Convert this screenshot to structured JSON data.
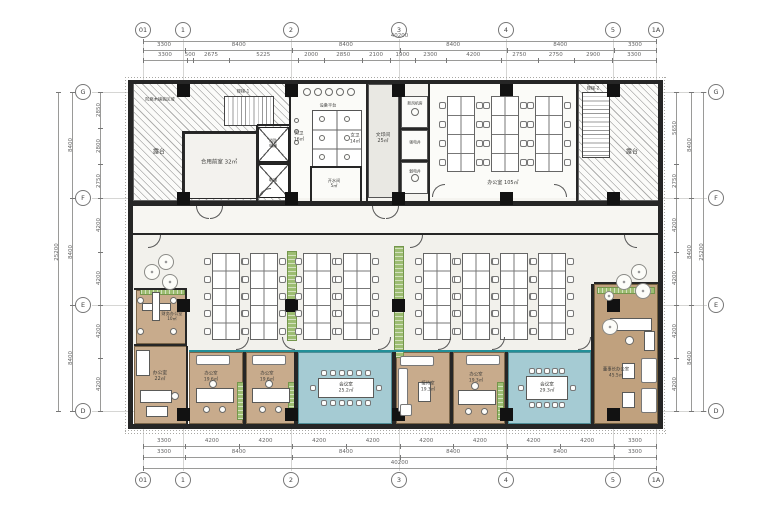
{
  "meta": {
    "width": 780,
    "height": 520,
    "bg": "#ffffff",
    "accent_teal": "#238f98",
    "accent_green": "#9dbd72",
    "accent_wood": "#c8ab8c"
  },
  "grid": {
    "cols": [
      {
        "label": "01",
        "x": 143
      },
      {
        "label": "1",
        "x": 183
      },
      {
        "label": "2",
        "x": 291
      },
      {
        "label": "3",
        "x": 399
      },
      {
        "label": "4",
        "x": 506
      },
      {
        "label": "5",
        "x": 613
      },
      {
        "label": "1A",
        "x": 656
      }
    ],
    "rows": [
      {
        "label": "G",
        "y": 92
      },
      {
        "label": "F",
        "y": 198
      },
      {
        "label": "E",
        "y": 305
      },
      {
        "label": "D",
        "y": 411
      }
    ],
    "top_y": 30,
    "bottom_y": 480,
    "left_x": 83,
    "right_x": 716
  },
  "dims": {
    "top": {
      "total": [
        "40200"
      ],
      "majors": [
        "3300",
        "8400",
        "8400",
        "8400",
        "8400",
        "3300"
      ],
      "minors": [
        "3300",
        "500",
        "2675",
        "5225",
        "2000",
        "2850",
        "2100",
        "1900",
        "2300",
        "4200",
        "2750",
        "2750",
        "2900",
        "3300"
      ]
    },
    "bottom": {
      "total": [
        "40200"
      ],
      "majors": [
        "3300",
        "8400",
        "8400",
        "8400",
        "8400",
        "3300"
      ],
      "minors": [
        "3300",
        "4200",
        "4200",
        "4200",
        "4200",
        "4200",
        "4200",
        "4200",
        "4200",
        "3300"
      ]
    },
    "left": {
      "total": [
        "25200"
      ],
      "majors": [
        "8400",
        "8400",
        "8400"
      ],
      "minors": [
        "2850",
        "2800",
        "2750",
        "4200",
        "4200",
        "4200",
        "4200"
      ]
    },
    "right": {
      "total": [
        "25200"
      ],
      "majors": [
        "8400",
        "8400",
        "8400"
      ],
      "minors": [
        "5650",
        "2750",
        "4200",
        "4200",
        "4200",
        "4200"
      ]
    }
  },
  "plan": {
    "floors": [
      {
        "n": "top-band-floor",
        "c": "floor-top",
        "x": 133,
        "y": 84,
        "w": 525,
        "h": 117
      },
      {
        "n": "terrace-left",
        "c": "hatch",
        "x": 133,
        "y": 82,
        "w": 157,
        "h": 119
      },
      {
        "n": "terrace-right",
        "c": "hatch",
        "x": 578,
        "y": 82,
        "w": 82,
        "h": 119
      },
      {
        "n": "stair-1",
        "c": "stairsH",
        "x": 224,
        "y": 96,
        "w": 50,
        "h": 30
      },
      {
        "n": "stair-2",
        "c": "stairsV",
        "x": 582,
        "y": 92,
        "w": 28,
        "h": 66
      },
      {
        "n": "shared-lobby",
        "c": "froom",
        "x": 184,
        "y": 133,
        "w": 73,
        "h": 66
      },
      {
        "n": "elevator-fire",
        "c": "elev",
        "x": 258,
        "y": 127,
        "w": 31,
        "h": 35
      },
      {
        "n": "elevator",
        "c": "elev",
        "x": 258,
        "y": 164,
        "w": 31,
        "h": 34
      },
      {
        "n": "toilet-zone",
        "c": "white",
        "x": 291,
        "y": 84,
        "w": 76,
        "h": 114
      },
      {
        "n": "toilet-stalls",
        "c": "stall",
        "x": 312,
        "y": 110,
        "w": 50,
        "h": 58
      },
      {
        "n": "water-room",
        "c": "white",
        "x": 312,
        "y": 168,
        "w": 48,
        "h": 30
      },
      {
        "n": "print-room",
        "c": "gray",
        "x": 368,
        "y": 84,
        "w": 31,
        "h": 114
      },
      {
        "n": "shaft-cell-1",
        "c": "cell",
        "x": 401,
        "y": 96,
        "w": 27,
        "h": 32
      },
      {
        "n": "shaft-cell-2",
        "c": "cell",
        "x": 401,
        "y": 130,
        "w": 27,
        "h": 30
      },
      {
        "n": "shaft-cell-3",
        "c": "cell",
        "x": 401,
        "y": 162,
        "w": 27,
        "h": 32
      },
      {
        "n": "office-top-floor",
        "c": "white",
        "x": 430,
        "y": 84,
        "w": 146,
        "h": 114
      },
      {
        "n": "corridor-floor",
        "c": "floor-cor",
        "x": 133,
        "y": 206,
        "w": 525,
        "h": 27
      },
      {
        "n": "open-office-floor",
        "c": "floor-open",
        "x": 133,
        "y": 235,
        "w": 525,
        "h": 115
      },
      {
        "n": "finance-office",
        "c": "wood",
        "x": 136,
        "y": 290,
        "w": 51,
        "h": 54
      },
      {
        "n": "office-22",
        "c": "wood",
        "x": 134,
        "y": 346,
        "w": 53,
        "h": 78
      },
      {
        "n": "office-a",
        "c": "wood",
        "x": 189,
        "y": 352,
        "w": 54,
        "h": 72
      },
      {
        "n": "office-b",
        "c": "wood",
        "x": 246,
        "y": 352,
        "w": 50,
        "h": 72
      },
      {
        "n": "meeting-1",
        "c": "teal",
        "x": 298,
        "y": 352,
        "w": 94,
        "h": 72
      },
      {
        "n": "reception",
        "c": "wood",
        "x": 396,
        "y": 352,
        "w": 54,
        "h": 72
      },
      {
        "n": "office-193",
        "c": "wood",
        "x": 453,
        "y": 352,
        "w": 52,
        "h": 72
      },
      {
        "n": "meeting-2",
        "c": "teal",
        "x": 508,
        "y": 352,
        "w": 83,
        "h": 72
      },
      {
        "n": "chairman-office",
        "c": "wood2",
        "x": 594,
        "y": 284,
        "w": 64,
        "h": 140
      }
    ],
    "walls": [
      [
        128,
        80,
        535,
        4
      ],
      [
        128,
        201,
        535,
        5
      ],
      [
        128,
        233,
        535,
        2
      ],
      [
        128,
        424,
        535,
        5
      ],
      [
        128,
        80,
        5,
        349
      ],
      [
        658,
        80,
        5,
        349
      ],
      [
        182,
        131,
        2,
        70
      ],
      [
        183,
        131,
        75,
        2
      ],
      [
        256,
        125,
        2,
        76
      ],
      [
        257,
        124,
        33,
        2
      ],
      [
        257,
        162,
        33,
        2
      ],
      [
        289,
        84,
        2,
        117
      ],
      [
        366,
        84,
        2,
        117
      ],
      [
        399,
        84,
        2,
        117
      ],
      [
        428,
        84,
        2,
        117
      ],
      [
        576,
        82,
        2,
        119
      ],
      [
        401,
        128,
        28,
        2
      ],
      [
        401,
        160,
        28,
        2
      ],
      [
        310,
        166,
        52,
        2
      ],
      [
        310,
        168,
        2,
        33
      ],
      [
        360,
        168,
        2,
        33
      ],
      [
        134,
        288,
        53,
        2
      ],
      [
        185,
        288,
        2,
        58
      ],
      [
        134,
        344,
        53,
        2
      ],
      [
        186,
        346,
        2,
        78
      ],
      [
        243,
        352,
        3,
        72
      ],
      [
        294,
        352,
        4,
        72
      ],
      [
        392,
        352,
        4,
        72
      ],
      [
        450,
        352,
        3,
        72
      ],
      [
        505,
        352,
        3,
        72
      ],
      [
        591,
        284,
        3,
        140
      ],
      [
        594,
        282,
        66,
        2
      ]
    ],
    "glass": [
      [
        189,
        350,
        402,
        2
      ]
    ],
    "columns": {
      "size": 13,
      "xs": [
        177,
        285,
        392,
        500,
        607
      ],
      "ys": [
        84,
        192,
        299,
        408
      ]
    },
    "planters": [
      {
        "c": "planter",
        "x": 287,
        "y": 251,
        "w": 10,
        "h": 90
      },
      {
        "c": "planter",
        "x": 394,
        "y": 246,
        "w": 10,
        "h": 112
      },
      {
        "c": "planterH",
        "x": 140,
        "y": 288,
        "w": 45,
        "h": 7
      },
      {
        "c": "planter",
        "x": 237,
        "y": 382,
        "w": 7,
        "h": 38
      },
      {
        "c": "planter",
        "x": 288,
        "y": 382,
        "w": 7,
        "h": 38
      },
      {
        "c": "planter",
        "x": 497,
        "y": 382,
        "w": 7,
        "h": 38
      },
      {
        "c": "planterH",
        "x": 597,
        "y": 287,
        "w": 58,
        "h": 7
      }
    ],
    "clusters": [
      {
        "x": 447,
        "y": 96,
        "w": 28,
        "h": 76,
        "rows": 4
      },
      {
        "x": 491,
        "y": 96,
        "w": 28,
        "h": 76,
        "rows": 4
      },
      {
        "x": 535,
        "y": 96,
        "w": 28,
        "h": 76,
        "rows": 4
      },
      {
        "x": 212,
        "y": 253,
        "w": 28,
        "h": 87,
        "rows": 5
      },
      {
        "x": 250,
        "y": 253,
        "w": 28,
        "h": 87,
        "rows": 5
      },
      {
        "x": 303,
        "y": 253,
        "w": 28,
        "h": 87,
        "rows": 5
      },
      {
        "x": 343,
        "y": 253,
        "w": 28,
        "h": 87,
        "rows": 5
      },
      {
        "x": 423,
        "y": 253,
        "w": 28,
        "h": 87,
        "rows": 5
      },
      {
        "x": 462,
        "y": 253,
        "w": 28,
        "h": 87,
        "rows": 5
      },
      {
        "x": 500,
        "y": 253,
        "w": 28,
        "h": 87,
        "rows": 5
      },
      {
        "x": 538,
        "y": 253,
        "w": 28,
        "h": 87,
        "rows": 5
      }
    ],
    "furniture": [
      {
        "c": "sofa",
        "x": 196,
        "y": 355,
        "w": 34,
        "h": 10
      },
      {
        "c": "sofa",
        "x": 252,
        "y": 355,
        "w": 34,
        "h": 10
      },
      {
        "c": "sofa",
        "x": 466,
        "y": 355,
        "w": 34,
        "h": 10
      },
      {
        "c": "desk",
        "x": 196,
        "y": 388,
        "w": 38,
        "h": 15
      },
      {
        "c": "desk",
        "x": 252,
        "y": 388,
        "w": 38,
        "h": 15
      },
      {
        "c": "desk",
        "x": 458,
        "y": 390,
        "w": 38,
        "h": 15
      },
      {
        "c": "desk",
        "x": 140,
        "y": 390,
        "w": 32,
        "h": 13
      },
      {
        "c": "desk",
        "x": 136,
        "y": 350,
        "w": 14,
        "h": 26
      },
      {
        "c": "desk",
        "x": 146,
        "y": 406,
        "w": 22,
        "h": 11
      },
      {
        "c": "desk",
        "x": 142,
        "y": 303,
        "w": 29,
        "h": 8
      },
      {
        "c": "desk",
        "x": 152,
        "y": 292,
        "w": 8,
        "h": 29
      },
      {
        "c": "sofa",
        "x": 400,
        "y": 356,
        "w": 34,
        "h": 10
      },
      {
        "c": "sofa",
        "x": 398,
        "y": 368,
        "w": 10,
        "h": 44
      },
      {
        "c": "sofa",
        "x": 400,
        "y": 404,
        "w": 12,
        "h": 12
      },
      {
        "c": "desk",
        "x": 418,
        "y": 382,
        "w": 13,
        "h": 20
      },
      {
        "c": "desk",
        "x": 610,
        "y": 318,
        "w": 42,
        "h": 13
      },
      {
        "c": "desk",
        "x": 644,
        "y": 331,
        "w": 11,
        "h": 20
      },
      {
        "c": "sofa",
        "x": 641,
        "y": 358,
        "w": 16,
        "h": 25
      },
      {
        "c": "sofa",
        "x": 641,
        "y": 388,
        "w": 16,
        "h": 25
      },
      {
        "c": "desk",
        "x": 622,
        "y": 363,
        "w": 13,
        "h": 16
      },
      {
        "c": "desk",
        "x": 622,
        "y": 392,
        "w": 13,
        "h": 16
      }
    ],
    "meetings": [
      {
        "x": 318,
        "y": 378,
        "w": 56,
        "h": 20,
        "top": 6,
        "bottom": 6,
        "left": 1,
        "right": 1
      },
      {
        "x": 526,
        "y": 376,
        "w": 42,
        "h": 24,
        "top": 5,
        "bottom": 5,
        "left": 1,
        "right": 1
      }
    ],
    "circles": [
      [
        307,
        92,
        4,
        "circ"
      ],
      [
        318,
        92,
        4,
        "circ"
      ],
      [
        329,
        92,
        4,
        "circ"
      ],
      [
        340,
        92,
        4,
        "circ"
      ],
      [
        351,
        92,
        4,
        "circ"
      ],
      [
        322,
        119,
        3,
        "circ"
      ],
      [
        347,
        119,
        3,
        "circ"
      ],
      [
        322,
        138,
        3,
        "circ"
      ],
      [
        347,
        138,
        3,
        "circ"
      ],
      [
        322,
        157,
        3,
        "circ"
      ],
      [
        347,
        157,
        3,
        "circ"
      ],
      [
        296,
        120,
        2.5,
        "circ"
      ],
      [
        296,
        131,
        2.5,
        "circ"
      ],
      [
        296,
        142,
        2.5,
        "circ"
      ],
      [
        415,
        112,
        4,
        "circ"
      ],
      [
        415,
        178,
        4,
        "circ"
      ],
      [
        152,
        272,
        8,
        "tree"
      ],
      [
        166,
        262,
        8,
        "tree"
      ],
      [
        170,
        282,
        8,
        "tree"
      ],
      [
        624,
        282,
        8,
        "tree"
      ],
      [
        639,
        272,
        8,
        "tree"
      ],
      [
        643,
        291,
        8,
        "tree"
      ],
      [
        609,
        296,
        5,
        "tree"
      ],
      [
        213,
        384,
        4,
        "circ"
      ],
      [
        206,
        409,
        3.5,
        "circ"
      ],
      [
        222,
        409,
        3.5,
        "circ"
      ],
      [
        269,
        384,
        4,
        "circ"
      ],
      [
        262,
        409,
        3.5,
        "circ"
      ],
      [
        278,
        409,
        3.5,
        "circ"
      ],
      [
        475,
        386,
        4,
        "circ"
      ],
      [
        468,
        411,
        3.5,
        "circ"
      ],
      [
        484,
        411,
        3.5,
        "circ"
      ],
      [
        175,
        396,
        4,
        "circ"
      ],
      [
        629,
        340,
        4.5,
        "circ"
      ],
      [
        610,
        327,
        8,
        "tree"
      ],
      [
        140,
        300,
        3.5,
        "circ"
      ],
      [
        173,
        300,
        3.5,
        "circ"
      ],
      [
        140,
        331,
        3.5,
        "circ"
      ],
      [
        173,
        331,
        3.5,
        "circ"
      ]
    ],
    "doors": [
      [
        196,
        206,
        "bl"
      ],
      [
        210,
        206,
        "br"
      ],
      [
        372,
        206,
        "bl"
      ],
      [
        386,
        206,
        "br"
      ],
      [
        148,
        235,
        "br"
      ],
      [
        410,
        235,
        "br"
      ],
      [
        624,
        235,
        "bl"
      ],
      [
        432,
        184,
        "tl"
      ],
      [
        554,
        184,
        "tr"
      ],
      [
        258,
        188,
        "tl"
      ],
      [
        236,
        337,
        "br"
      ],
      [
        282,
        337,
        "bl"
      ],
      [
        378,
        337,
        "br"
      ],
      [
        438,
        337,
        "br"
      ],
      [
        492,
        337,
        "br"
      ],
      [
        578,
        337,
        "br"
      ]
    ],
    "labels": [
      {
        "x": 160,
        "y": 99,
        "t": "防腐木铺装区域",
        "fs": 4.2
      },
      {
        "x": 159,
        "y": 152,
        "t": "露台",
        "fs": 6
      },
      {
        "x": 219,
        "y": 163,
        "t": "合用前室 32㎡",
        "fs": 5.5
      },
      {
        "x": 243,
        "y": 91,
        "t": "楼梯-1",
        "fs": 4.2
      },
      {
        "x": 273,
        "y": 143,
        "t": "消防\n电梯",
        "fs": 4
      },
      {
        "x": 273,
        "y": 180,
        "t": "电梯",
        "fs": 4.2
      },
      {
        "x": 299,
        "y": 137,
        "t": "男卫\n16㎡",
        "fs": 4.5
      },
      {
        "x": 355,
        "y": 139,
        "t": "女卫\n14㎡",
        "fs": 4.5
      },
      {
        "x": 328,
        "y": 105,
        "t": "设备平台",
        "fs": 4.2
      },
      {
        "x": 334,
        "y": 183,
        "t": "开水间\n5㎡",
        "fs": 4.2
      },
      {
        "x": 383,
        "y": 139,
        "t": "文印间\n25㎡",
        "fs": 4.8
      },
      {
        "x": 415,
        "y": 104,
        "t": "新风机房",
        "fs": 3.8
      },
      {
        "x": 415,
        "y": 143,
        "t": "强电井",
        "fs": 3.8
      },
      {
        "x": 415,
        "y": 172,
        "t": "弱电井",
        "fs": 3.8
      },
      {
        "x": 503,
        "y": 183,
        "t": "办公室 105㎡",
        "fs": 5
      },
      {
        "x": 593,
        "y": 88,
        "t": "楼梯-2",
        "fs": 4.2
      },
      {
        "x": 632,
        "y": 152,
        "t": "露台",
        "fs": 6
      },
      {
        "x": 172,
        "y": 316,
        "t": "财务办公室\n10㎡",
        "fs": 4.2
      },
      {
        "x": 160,
        "y": 377,
        "t": "办公室\n22㎡",
        "fs": 4.8
      },
      {
        "x": 211,
        "y": 377,
        "t": "办公室\n19.6㎡",
        "fs": 4.4
      },
      {
        "x": 267,
        "y": 377,
        "t": "办公室\n19.6㎡",
        "fs": 4.4
      },
      {
        "x": 346,
        "y": 388,
        "t": "会议室\n25.2㎡",
        "fs": 4.6
      },
      {
        "x": 428,
        "y": 387,
        "t": "接待室\n19.3㎡",
        "fs": 4.4
      },
      {
        "x": 476,
        "y": 378,
        "t": "办公室\n19.3㎡",
        "fs": 4.4
      },
      {
        "x": 547,
        "y": 388,
        "t": "会议室\n29.3㎡",
        "fs": 4.6
      },
      {
        "x": 616,
        "y": 373,
        "t": "董事长办公室\n45.5㎡",
        "fs": 4.4
      }
    ]
  }
}
